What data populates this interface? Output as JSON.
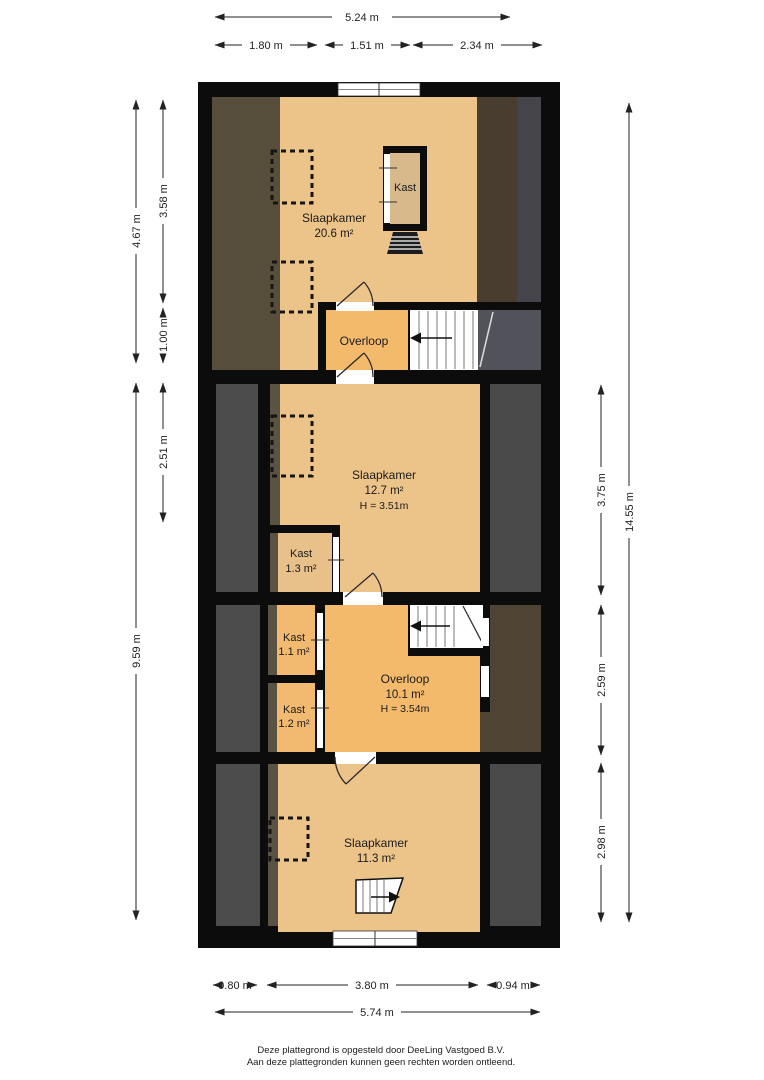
{
  "title": "Floor plan (plattegrond) - attic / bedroom floor",
  "dims": {
    "top_total": "5.24 m",
    "top_seg1": "1.80 m",
    "top_seg2": "1.51 m",
    "top_seg3": "2.34 m",
    "left_outer_top": "4.67 m",
    "left_outer_bottom": "9.59 m",
    "left_inner_top": "3.58 m",
    "left_inner_mid": "1.00 m",
    "left_inner_bottom": "2.51 m",
    "right_outer": "14.55 m",
    "right_inner_top": "3.75 m",
    "right_inner_mid": "2.59 m",
    "right_inner_bottom": "2.98 m",
    "bottom_seg1": "0.80 m",
    "bottom_seg2": "3.80 m",
    "bottom_seg3": "0.94 m",
    "bottom_total": "5.74 m"
  },
  "rooms": {
    "bedroom1": {
      "name": "Slaapkamer",
      "area": "20.6 m²"
    },
    "closet_top": {
      "name": "Kast"
    },
    "landing_top": {
      "name": "Overloop"
    },
    "bedroom2": {
      "name": "Slaapkamer",
      "area": "12.7 m²",
      "height": "H = 3.51m"
    },
    "closet_13": {
      "name": "Kast",
      "area": "1.3 m²"
    },
    "closet_11": {
      "name": "Kast",
      "area": "1.1 m²"
    },
    "closet_12": {
      "name": "Kast",
      "area": "1.2 m²"
    },
    "landing_main": {
      "name": "Overloop",
      "area": "10.1 m²",
      "height": "H = 3.54m"
    },
    "bedroom3": {
      "name": "Slaapkamer",
      "area": "11.3 m²"
    }
  },
  "footer": {
    "line1": "Deze plattegrond is opgesteld door DeeLing Vastgoed B.V.",
    "line2": "Aan deze plattegronden kunnen geen rechten worden ontleend."
  },
  "colors": {
    "floor_tan": "#ecc489",
    "landing_orange": "#f4ba6c",
    "closet_interior": "#d8b98c",
    "dark_gray": "#4a4a4a",
    "dark_brown": "#4f4434",
    "olive_brown": "#564e3b",
    "wall_black": "#0c0c0c",
    "background": "#ffffff"
  }
}
